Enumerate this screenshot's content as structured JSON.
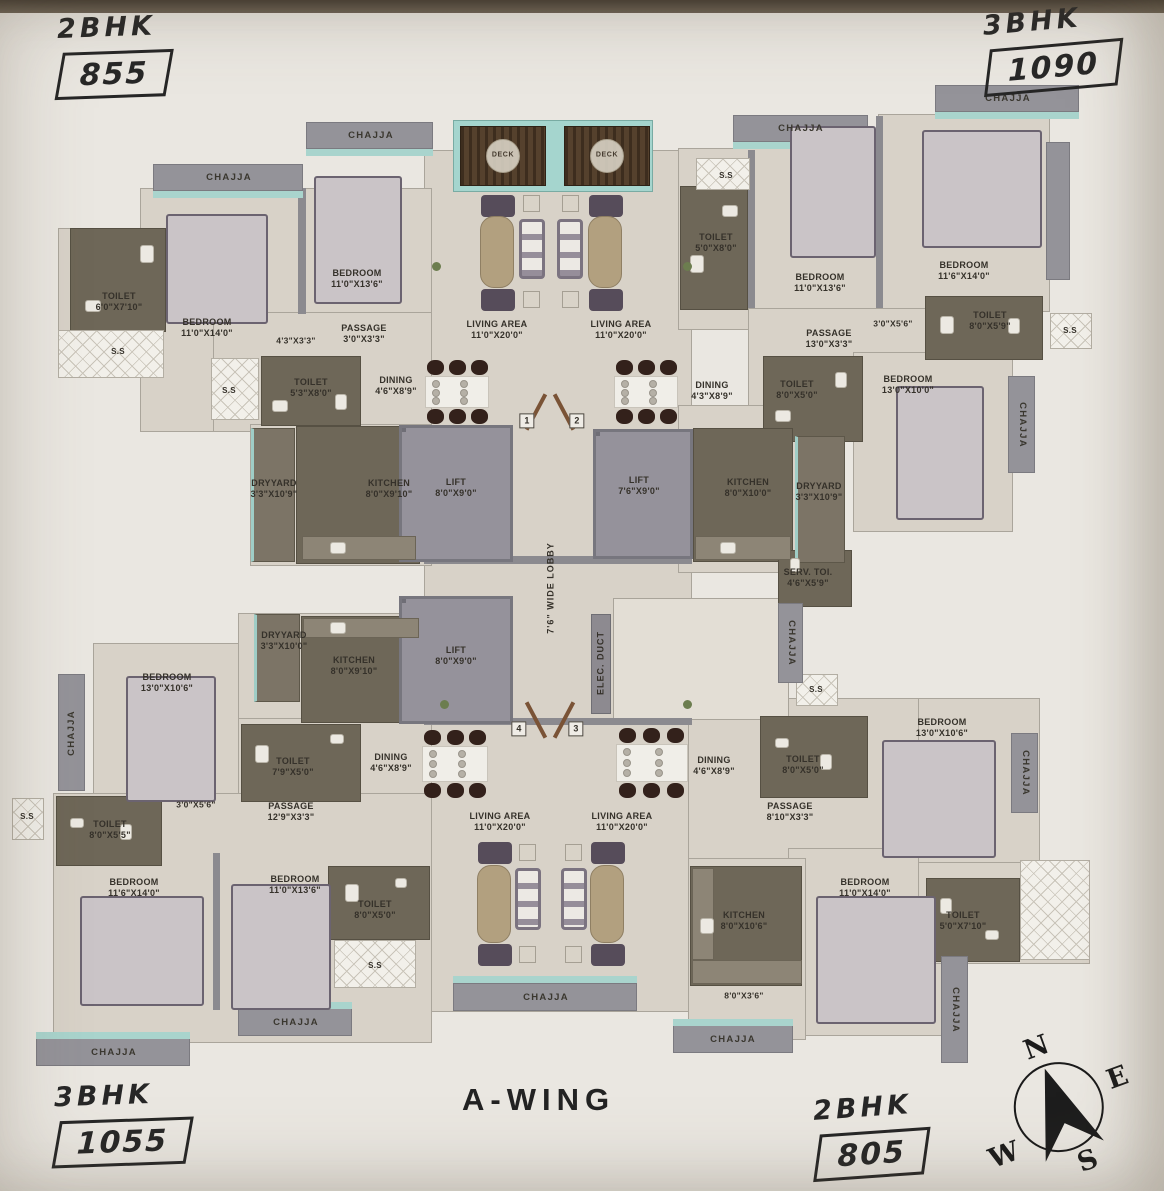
{
  "title": "A-WING",
  "units": {
    "top_left": {
      "type": "2BHK",
      "area": "855"
    },
    "top_right": {
      "type": "3BHK",
      "area": "1090"
    },
    "bottom_left": {
      "type": "3BHK",
      "area": "1055"
    },
    "bottom_right": {
      "type": "2BHK",
      "area": "805"
    }
  },
  "compass": {
    "north": "N",
    "east": "E",
    "south": "S",
    "west": "W"
  },
  "colors": {
    "paper": "#eae7e1",
    "floor": "#d8d2c8",
    "dark_room": "#6e6758",
    "wall_gray": "#8b8a8f",
    "chajja_gray": "#949399",
    "teal_sill": "#a9d4cd",
    "deck_wood": "#4a3827",
    "annotation_ink": "#272727"
  },
  "plan": {
    "labels": [
      {
        "t": [
          "CHAJJA"
        ],
        "x": 229,
        "y": 178,
        "k": "chajja"
      },
      {
        "t": [
          "CHAJJA"
        ],
        "x": 371,
        "y": 136,
        "k": "chajja"
      },
      {
        "t": [
          "CHAJJA"
        ],
        "x": 801,
        "y": 129,
        "k": "chajja"
      },
      {
        "t": [
          "CHAJJA"
        ],
        "x": 1008,
        "y": 99,
        "k": "chajja"
      },
      {
        "t": [
          "CHAJJA"
        ],
        "x": 546,
        "y": 998,
        "k": "chajja"
      },
      {
        "t": [
          "CHAJJA"
        ],
        "x": 296,
        "y": 1023,
        "k": "chajja"
      },
      {
        "t": [
          "CHAJJA"
        ],
        "x": 114,
        "y": 1053,
        "k": "chajja"
      },
      {
        "t": [
          "CHAJJA"
        ],
        "x": 733,
        "y": 1040,
        "k": "chajja"
      },
      {
        "t": [
          "CHAJJA"
        ],
        "x": 72,
        "y": 733,
        "k": "chajja",
        "r": -90
      },
      {
        "t": [
          "CHAJJA"
        ],
        "x": 1022,
        "y": 425,
        "k": "chajja",
        "r": 90
      },
      {
        "t": [
          "CHAJJA"
        ],
        "x": 791,
        "y": 643,
        "k": "chajja",
        "r": 90
      },
      {
        "t": [
          "CHAJJA"
        ],
        "x": 1025,
        "y": 773,
        "k": "chajja",
        "r": 90
      },
      {
        "t": [
          "CHAJJA"
        ],
        "x": 955,
        "y": 1010,
        "k": "chajja",
        "r": 90
      },
      {
        "t": [
          "S.S"
        ],
        "x": 118,
        "y": 352,
        "k": "ss"
      },
      {
        "t": [
          "S.S"
        ],
        "x": 229,
        "y": 391,
        "k": "ss"
      },
      {
        "t": [
          "S.S"
        ],
        "x": 726,
        "y": 176,
        "k": "ss"
      },
      {
        "t": [
          "S.S"
        ],
        "x": 1070,
        "y": 331,
        "k": "ss"
      },
      {
        "t": [
          "S.S"
        ],
        "x": 816,
        "y": 690,
        "k": "ss"
      },
      {
        "t": [
          "S.S"
        ],
        "x": 375,
        "y": 966,
        "k": "ss"
      },
      {
        "t": [
          "S.S"
        ],
        "x": 27,
        "y": 817,
        "k": "ss"
      },
      {
        "t": [
          "TOILET",
          "6'0\"X7'10\""
        ],
        "x": 119,
        "y": 302,
        "k": "room"
      },
      {
        "t": [
          "BEDROOM",
          "11'0\"X14'0\""
        ],
        "x": 207,
        "y": 328,
        "k": "room"
      },
      {
        "t": [
          "BEDROOM",
          "11'0\"X13'6\""
        ],
        "x": 357,
        "y": 279,
        "k": "room"
      },
      {
        "t": [
          "PASSAGE",
          "3'0\"X3'3\""
        ],
        "x": 364,
        "y": 334,
        "k": "room"
      },
      {
        "t": [
          "4'3\"X3'3\""
        ],
        "x": 296,
        "y": 341,
        "k": "dim"
      },
      {
        "t": [
          "TOILET",
          "5'3\"X8'0\""
        ],
        "x": 311,
        "y": 388,
        "k": "room"
      },
      {
        "t": [
          "DINING",
          "4'6\"X8'9\""
        ],
        "x": 396,
        "y": 386,
        "k": "room"
      },
      {
        "t": [
          "DRYYARD",
          "3'3\"X10'9\""
        ],
        "x": 274,
        "y": 489,
        "k": "room"
      },
      {
        "t": [
          "KITCHEN",
          "8'0\"X9'10\""
        ],
        "x": 389,
        "y": 489,
        "k": "room"
      },
      {
        "t": [
          "LIFT",
          "8'0\"X9'0\""
        ],
        "x": 456,
        "y": 488,
        "k": "room"
      },
      {
        "t": [
          "LIFT",
          "7'6\"X9'0\""
        ],
        "x": 639,
        "y": 486,
        "k": "room"
      },
      {
        "t": [
          "KITCHEN",
          "8'0\"X10'0\""
        ],
        "x": 748,
        "y": 488,
        "k": "room"
      },
      {
        "t": [
          "DRYYARD",
          "3'3\"X10'9\""
        ],
        "x": 819,
        "y": 492,
        "k": "room"
      },
      {
        "t": [
          "LIVING AREA",
          "11'0\"X20'0\""
        ],
        "x": 497,
        "y": 330,
        "k": "room"
      },
      {
        "t": [
          "LIVING AREA",
          "11'0\"X20'0\""
        ],
        "x": 621,
        "y": 330,
        "k": "room"
      },
      {
        "t": [
          "DINING",
          "4'3\"X8'9\""
        ],
        "x": 712,
        "y": 391,
        "k": "room"
      },
      {
        "t": [
          "TOILET",
          "5'0\"X8'0\""
        ],
        "x": 716,
        "y": 243,
        "k": "room"
      },
      {
        "t": [
          "BEDROOM",
          "11'0\"X13'6\""
        ],
        "x": 820,
        "y": 283,
        "k": "room"
      },
      {
        "t": [
          "BEDROOM",
          "11'6\"X14'0\""
        ],
        "x": 964,
        "y": 271,
        "k": "room"
      },
      {
        "t": [
          "PASSAGE",
          "13'0\"X3'3\""
        ],
        "x": 829,
        "y": 339,
        "k": "room"
      },
      {
        "t": [
          "3'0\"X5'6\""
        ],
        "x": 893,
        "y": 324,
        "k": "dim"
      },
      {
        "t": [
          "TOILET",
          "8'0\"X5'9\""
        ],
        "x": 990,
        "y": 321,
        "k": "room"
      },
      {
        "t": [
          "TOILET",
          "8'0\"X5'0\""
        ],
        "x": 797,
        "y": 390,
        "k": "room"
      },
      {
        "t": [
          "BEDROOM",
          "13'0\"X10'0\""
        ],
        "x": 908,
        "y": 385,
        "k": "room"
      },
      {
        "t": [
          "SERV. TOI.",
          "4'6\"X5'9\""
        ],
        "x": 808,
        "y": 578,
        "k": "room"
      },
      {
        "t": [
          "ELEC. DUCT"
        ],
        "x": 601,
        "y": 663,
        "k": "vert",
        "r": -90
      },
      {
        "t": [
          "7'6\" WIDE LOBBY"
        ],
        "x": 551,
        "y": 588,
        "k": "vert",
        "r": -90
      },
      {
        "t": [
          "BEDROOM",
          "13'0\"X10'6\""
        ],
        "x": 167,
        "y": 683,
        "k": "room"
      },
      {
        "t": [
          "DRYYARD",
          "3'3\"X10'0\""
        ],
        "x": 284,
        "y": 641,
        "k": "room"
      },
      {
        "t": [
          "KITCHEN",
          "8'0\"X9'10\""
        ],
        "x": 354,
        "y": 666,
        "k": "room"
      },
      {
        "t": [
          "LIFT",
          "8'0\"X9'0\""
        ],
        "x": 456,
        "y": 656,
        "k": "room"
      },
      {
        "t": [
          "TOILET",
          "7'9\"X5'0\""
        ],
        "x": 293,
        "y": 767,
        "k": "room"
      },
      {
        "t": [
          "DINING",
          "4'6\"X8'9\""
        ],
        "x": 391,
        "y": 763,
        "k": "room"
      },
      {
        "t": [
          "PASSAGE",
          "12'9\"X3'3\""
        ],
        "x": 291,
        "y": 812,
        "k": "room"
      },
      {
        "t": [
          "3'0\"X5'6\""
        ],
        "x": 196,
        "y": 805,
        "k": "dim"
      },
      {
        "t": [
          "TOILET",
          "8'0\"X5'5\""
        ],
        "x": 110,
        "y": 830,
        "k": "room"
      },
      {
        "t": [
          "BEDROOM",
          "11'6\"X14'0\""
        ],
        "x": 134,
        "y": 888,
        "k": "room"
      },
      {
        "t": [
          "BEDROOM",
          "11'0\"X13'6\""
        ],
        "x": 295,
        "y": 885,
        "k": "room"
      },
      {
        "t": [
          "TOILET",
          "8'0\"X5'0\""
        ],
        "x": 375,
        "y": 910,
        "k": "room"
      },
      {
        "t": [
          "LIVING AREA",
          "11'0\"X20'0\""
        ],
        "x": 500,
        "y": 822,
        "k": "room"
      },
      {
        "t": [
          "LIVING AREA",
          "11'0\"X20'0\""
        ],
        "x": 622,
        "y": 822,
        "k": "room"
      },
      {
        "t": [
          "DINING",
          "4'6\"X8'9\""
        ],
        "x": 714,
        "y": 766,
        "k": "room"
      },
      {
        "t": [
          "TOILET",
          "8'0\"X5'0\""
        ],
        "x": 803,
        "y": 765,
        "k": "room"
      },
      {
        "t": [
          "PASSAGE",
          "8'10\"X3'3\""
        ],
        "x": 790,
        "y": 812,
        "k": "room"
      },
      {
        "t": [
          "BEDROOM",
          "13'0\"X10'6\""
        ],
        "x": 942,
        "y": 728,
        "k": "room"
      },
      {
        "t": [
          "BEDROOM",
          "11'0\"X14'0\""
        ],
        "x": 865,
        "y": 888,
        "k": "room"
      },
      {
        "t": [
          "KITCHEN",
          "8'0\"X10'6\""
        ],
        "x": 744,
        "y": 921,
        "k": "room"
      },
      {
        "t": [
          "TOILET",
          "5'0\"X7'10\""
        ],
        "x": 963,
        "y": 921,
        "k": "room"
      },
      {
        "t": [
          "8'0\"X3'6\""
        ],
        "x": 744,
        "y": 996,
        "k": "dim"
      },
      {
        "t": [
          "DECK"
        ],
        "x": 503,
        "y": 156,
        "k": "deck"
      },
      {
        "t": [
          "DECK"
        ],
        "x": 607,
        "y": 156,
        "k": "deck"
      },
      {
        "t": [
          "1"
        ],
        "x": 527,
        "y": 421,
        "k": "door"
      },
      {
        "t": [
          "2"
        ],
        "x": 577,
        "y": 421,
        "k": "door"
      },
      {
        "t": [
          "4"
        ],
        "x": 519,
        "y": 729,
        "k": "door"
      },
      {
        "t": [
          "3"
        ],
        "x": 576,
        "y": 729,
        "k": "door"
      }
    ]
  }
}
